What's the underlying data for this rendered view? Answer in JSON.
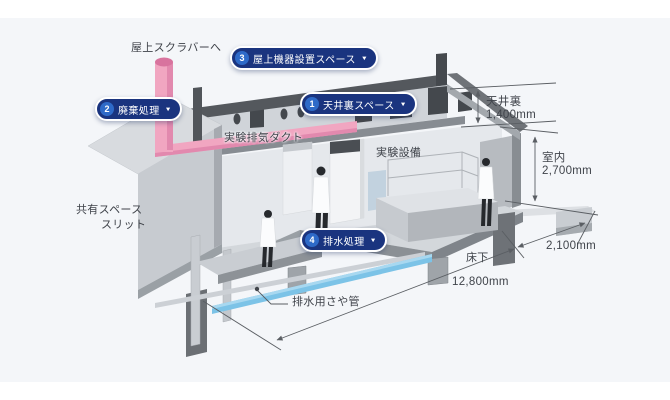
{
  "buttons": [
    {
      "number": "1",
      "label": "天井裏スペース",
      "caret": "▼"
    },
    {
      "number": "2",
      "label": "廃棄処理",
      "caret": "▼"
    },
    {
      "number": "3",
      "label": "屋上機器設置スペース",
      "caret": "▼"
    },
    {
      "number": "4",
      "label": "排水処理",
      "caret": "▼"
    }
  ],
  "labels": {
    "to_rooftop_scrubber": "屋上スクラバーへ",
    "exhaust_duct": "実験排気ダクト",
    "lab_equipment": "実験設備",
    "shared_space": "共有スペース",
    "slit": "スリット",
    "drain_sheath_pipe": "排水用さや管",
    "underfloor": "床下"
  },
  "dimensions": {
    "ceiling_plenum": {
      "label": "天井裏",
      "value": "1,400mm"
    },
    "room": {
      "label": "室内",
      "value": "2,700mm"
    },
    "right_overhang": {
      "value": "2,100mm"
    },
    "total_length": {
      "value": "12,800mm"
    }
  },
  "colors": {
    "button_bg": "#1a347f",
    "button_number_circle": "#2e6ac8",
    "duct_pink": "#f1a6c1",
    "pipe_blue": "#7cc3e7",
    "canvas_bg": "#f4f6f9"
  }
}
